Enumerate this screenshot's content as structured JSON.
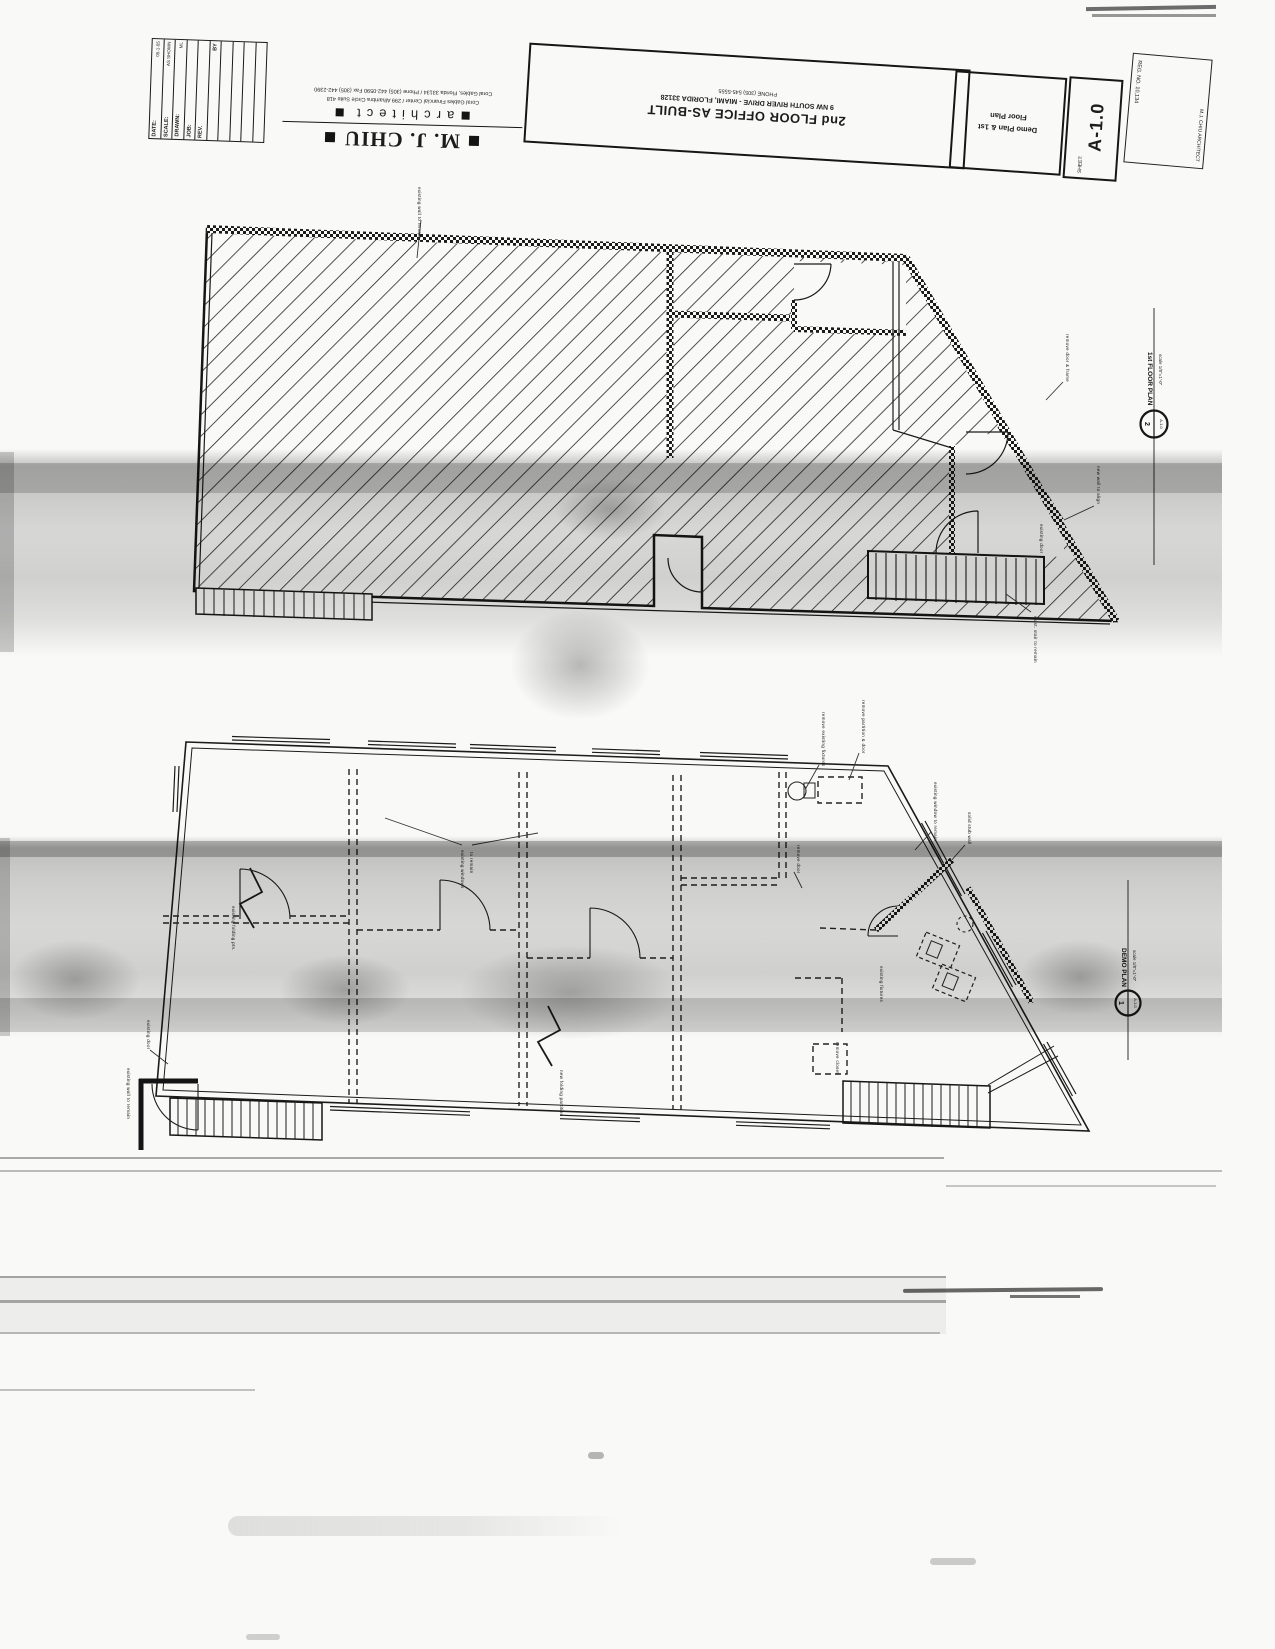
{
  "colors": {
    "ink": "#1c1c1c",
    "paper": "#f9f9f7",
    "scan_band": "#9a9a9a"
  },
  "title_block": {
    "firm_name": "M. J. CHIU",
    "firm_tagline": "architect",
    "firm_address1": "Coral Gables Financial Center / 299 Alhambra Circle Suite 418",
    "firm_address2": "Coral Gables, Florida 33134 / Phone (305) 442-0590 Fax (305) 442-2390",
    "project_title": "2nd FLOOR OFFICE AS-BUILT",
    "project_address": "9 NW SOUTH RIVER DRIVE - MIAMI, FLORIDA 33128",
    "project_phone": "PHONE (305) 545-5555",
    "content_line1": "Demo Plan & 1st",
    "content_line2": "Floor Plan",
    "sheet_label": "SHEET:",
    "sheet_number": "A-1.0",
    "stamp_name": "M.J. CHIU ARCHITECT",
    "stamp_reg": "REG. NO. 10,134",
    "rev_table": {
      "date_label": "DATE:",
      "date_value": "05-1-05",
      "scale_label": "SCALE:",
      "scale_value": "AS SHOWN",
      "drawn_label": "DRAWN:",
      "drawn_value": "ML",
      "job_label": "JOB:",
      "rev_label": "REV.",
      "by_label": "BY"
    }
  },
  "callouts": {
    "first_floor": {
      "title": "1st FLOOR PLAN",
      "scale": "scale 1/8\"=1'-0\"",
      "num": "2",
      "sheet": "A-1.0"
    },
    "demo": {
      "title": "DEMO PLAN",
      "scale": "scale 1/8\"=1'-0\"",
      "num": "1",
      "sheet": "A-1.0"
    }
  },
  "annotations": {
    "u1": "existing wall to remain",
    "u2": "remove door & frame",
    "u3": "new wall to align",
    "u4": "exist. stair to remain",
    "u5": "existing door",
    "l1": "remove existing fixtures",
    "l2": "remove partition & door",
    "l3a": "existing windows",
    "l3b": "to remain",
    "l4": "existing folding ptn.",
    "l5": "existing door",
    "l6": "existing wall to remain",
    "l7": "existing fixtures",
    "l8": "new folding partition",
    "l9": "remove closet",
    "l10": "remove door",
    "l11": "existing window to remain",
    "l12": "solid stub wall"
  }
}
